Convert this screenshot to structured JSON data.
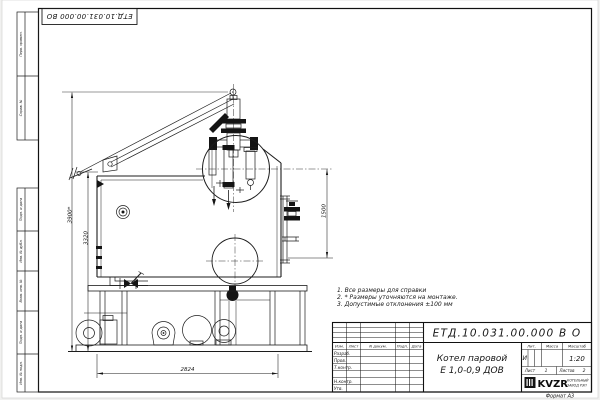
{
  "sheet": {
    "designation": "ЕТД.10.031.00.000 ВО",
    "format_note": "Формат А3"
  },
  "side_columns": {
    "top": [
      "Перв. примен.",
      "Справ. №"
    ],
    "bottom": [
      "Подп. и дата",
      "Инв. № дубл.",
      "Взам. инв. №",
      "Подп. и дата",
      "Инв. № подл."
    ]
  },
  "notes": [
    "1. Все размеры для справки",
    "2. * Размеры уточняются на монтаже.",
    "3. Допустимые отклонения  ±100 мм"
  ],
  "dimensions": {
    "overall_height": "3900*",
    "drum_height": "3320",
    "right_height": "1500",
    "base_length": "2824"
  },
  "title_block": {
    "designation": "ЕТД.10.031.00.000  В О",
    "name_line1": "Котел паровой",
    "name_line2": "Е 1,0-0,9 ДОВ",
    "col_izm": "Изм.",
    "col_list": "Лист",
    "col_doc": "N докум.",
    "col_sign": "Подп.",
    "col_date": "Дата",
    "row_developed": "Разраб.",
    "row_checked": "Пров.",
    "row_tcontrol": "Т.контр.",
    "row_ncontrol": "Н.контр.",
    "row_approved": "Утв.",
    "lit_label": "Лит.",
    "lit_value": "И",
    "mass_label": "Масса",
    "scale_label": "Масштаб",
    "scale_value": "1:20",
    "sheet_label": "Лист",
    "sheet_value": "1",
    "sheets_label": "Листов",
    "sheets_value": "2",
    "company_logo": "KVZR",
    "company_line1": "КОТЕЛЬНЫЙ",
    "company_line2": "ЗАВОД РЭП"
  }
}
